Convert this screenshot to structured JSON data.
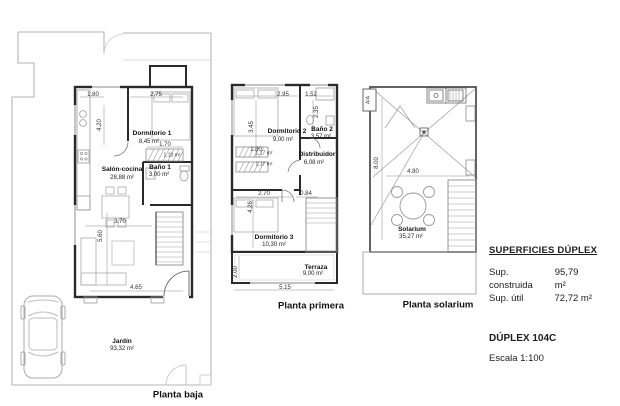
{
  "info": {
    "superficies_title": "SUPERFICIES DÚPLEX",
    "construida_label": "Sup. construida",
    "construida_value": "95,79 m²",
    "util_label": "Sup. útil",
    "util_value": "72,72 m²",
    "model_name": "DÚPLEX 104C",
    "scale_label": "Escala 1:100"
  },
  "plans": {
    "baja": {
      "caption": "Planta baja",
      "dormitorio1_name": "Dormitorio 1",
      "dormitorio1_area": "8,45 m²",
      "salon_name": "Salón-cocina",
      "salon_area": "28,88 m²",
      "bano1_name": "Baño 1",
      "bano1_area": "3,00 m²",
      "jardin_name": "Jardín",
      "jardin_area": "93,32 m²",
      "understair_area": "1,10 m²",
      "dim_kitchen_width": "1.80",
      "dim_dorm1_width": "2.75",
      "dim_kitchen_height": "4.20",
      "dim_stair_width": "1.70",
      "dim_salon_width": "3.70",
      "dim_salon_height": "5.60",
      "dim_bottom_width": "4.65"
    },
    "primera": {
      "caption": "Planta primera",
      "dormitorio2_name": "Dormitorio 2",
      "dormitorio2_area": "9,00 m²",
      "bano2_name": "Baño 2",
      "bano2_area": "3,57 m²",
      "distribuidor_name": "Distribuidor",
      "distribuidor_area": "6,08 m²",
      "dormitorio3_name": "Dormitorio 3",
      "dormitorio3_area": "10,30 m²",
      "terraza_name": "Terraza",
      "terraza_area": "9,00 m²",
      "stair_flight1_area": "1,17 m²",
      "stair_flight2_area": "1,17 m²",
      "dim_dorm2_width": "2.95",
      "dim_bano2_width": "1.52",
      "dim_dorm2_height": "3.45",
      "dim_bano2_height": "2.35",
      "dim_stair_width": "1.80",
      "dim_dorm3_width": "2.70",
      "dim_hall_width": "0.84",
      "dim_dorm3_height": "4.26",
      "dim_terraza_height": "2.00",
      "dim_total_width": "5.15"
    },
    "solarium": {
      "caption": "Planta solarium",
      "solarium_name": "Solarium",
      "solarium_area": "35,27 m²",
      "ac_label": "A/A",
      "dim_height": "8.00",
      "dim_width": "4.80"
    }
  }
}
